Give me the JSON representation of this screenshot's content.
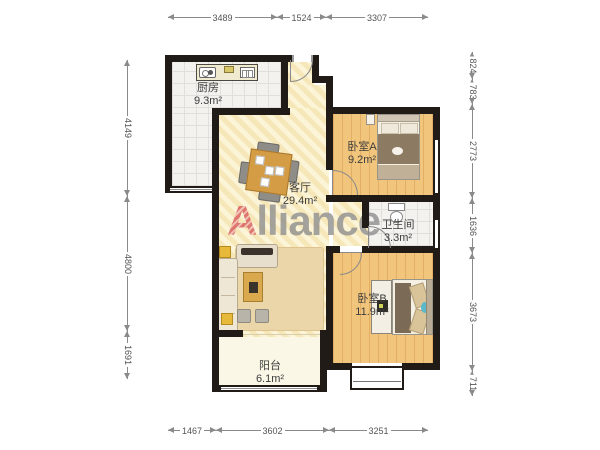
{
  "watermark": {
    "first_letter": "A",
    "rest": "lliance"
  },
  "rooms": {
    "kitchen": {
      "name": "厨房",
      "area": "9.3m²"
    },
    "living": {
      "name": "客厅",
      "area": "29.4m²"
    },
    "bedroom_a": {
      "name": "卧室A",
      "area": "9.2m²"
    },
    "bathroom": {
      "name": "卫生间",
      "area": "3.3m²"
    },
    "bedroom_b": {
      "name": "卧室B",
      "area": "11.9m²"
    },
    "balcony": {
      "name": "阳台",
      "area": "6.1m²"
    }
  },
  "dimensions": {
    "top": [
      "3489",
      "1524",
      "3307"
    ],
    "bottom": [
      "1467",
      "3602",
      "3251"
    ],
    "left": [
      "4149",
      "4800",
      "1691"
    ],
    "right": [
      "824",
      "783",
      "2773",
      "1636",
      "3673",
      "711"
    ]
  },
  "colors": {
    "wall": "#201b17",
    "wood_floor": "#f2c57c",
    "living_floor": "#f7ebc2",
    "watermark_accent": "#d95b5b",
    "watermark_text": "#8f8f8f"
  }
}
